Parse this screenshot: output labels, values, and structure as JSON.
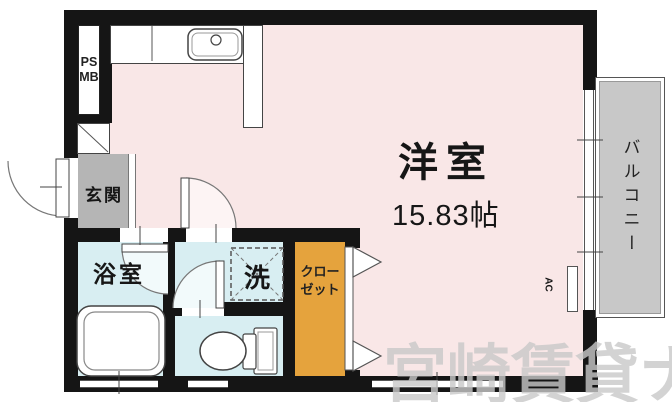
{
  "floor_plan": {
    "main_room": {
      "name": "洋室",
      "size": "15.83帖"
    },
    "balcony": {
      "name": "バルコニー"
    },
    "entrance": {
      "name": "玄関"
    },
    "bathroom": {
      "name": "浴室"
    },
    "laundry_space": {
      "name": "洗"
    },
    "closet": {
      "name_line1": "クロー",
      "name_line2": "ゼット"
    },
    "pipe_shaft": {
      "line1": "PS",
      "line2": "MB"
    },
    "air_conditioner": {
      "label": "AC"
    }
  },
  "watermark": {
    "text": "宮崎賃貸ナビ"
  },
  "colors": {
    "wall": "#151515",
    "main_room": "#f9e7e7",
    "wet_room": "#d8eef2",
    "closet": "#e5a33d",
    "entrance_floor": "#b5b5b5",
    "balcony": "#c8c8c8",
    "watermark": "#c9c9c9"
  }
}
